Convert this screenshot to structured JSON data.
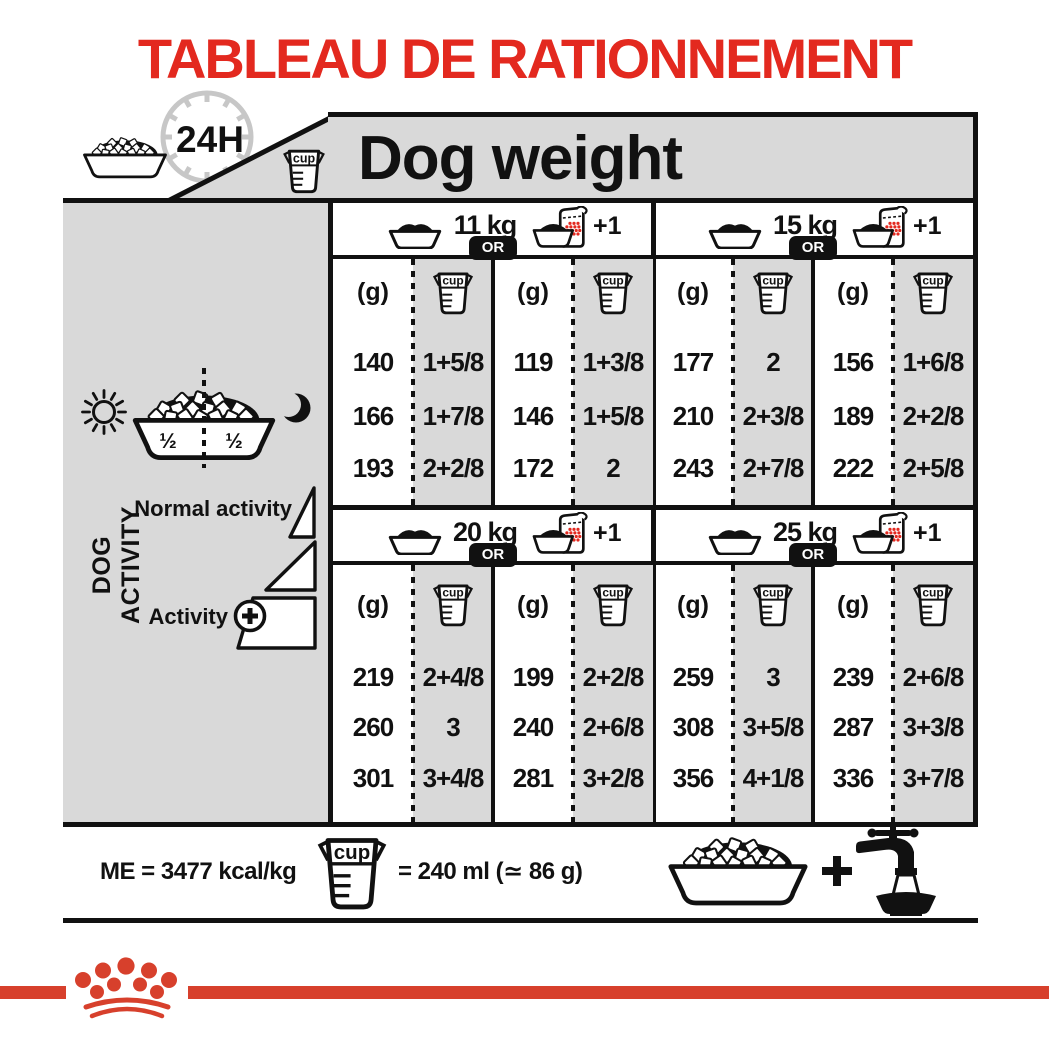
{
  "title": "TABLEAU DE RATIONNEMENT",
  "cup_label": "cup",
  "colors": {
    "accent_red": "#e3291f",
    "crown_red": "#d7402c",
    "panel_grey": "#d9d9d9"
  },
  "header": {
    "clock_label": "24H",
    "col_title": "Dog weight"
  },
  "sidebar": {
    "axis_label": "DOG ACTIVITY",
    "bowl_half_left": "½",
    "bowl_half_right": "½",
    "row_normal": "Normal activity",
    "row_plus": "Activity",
    "plus_sign": "+"
  },
  "table": {
    "or_label": "OR",
    "plus_one": "+1",
    "unit_g": "(g)",
    "groups": [
      {
        "weight": "11 kg",
        "rows": [
          [
            "140",
            "1+5/8",
            "119",
            "1+3/8"
          ],
          [
            "166",
            "1+7/8",
            "146",
            "1+5/8"
          ],
          [
            "193",
            "2+2/8",
            "172",
            "2"
          ]
        ]
      },
      {
        "weight": "15 kg",
        "rows": [
          [
            "177",
            "2",
            "156",
            "1+6/8"
          ],
          [
            "210",
            "2+3/8",
            "189",
            "2+2/8"
          ],
          [
            "243",
            "2+7/8",
            "222",
            "2+5/8"
          ]
        ]
      },
      {
        "weight": "20 kg",
        "rows": [
          [
            "219",
            "2+4/8",
            "199",
            "2+2/8"
          ],
          [
            "260",
            "3",
            "240",
            "2+6/8"
          ],
          [
            "301",
            "3+4/8",
            "281",
            "3+2/8"
          ]
        ]
      },
      {
        "weight": "25 kg",
        "rows": [
          [
            "259",
            "3",
            "239",
            "2+6/8"
          ],
          [
            "308",
            "3+5/8",
            "287",
            "3+3/8"
          ],
          [
            "356",
            "4+1/8",
            "336",
            "3+7/8"
          ]
        ]
      }
    ]
  },
  "footer": {
    "energy": "ME = 3477 kcal/kg",
    "cup_equivalence": "= 240 ml (≃ 86 g)",
    "plus_sign": "+"
  }
}
